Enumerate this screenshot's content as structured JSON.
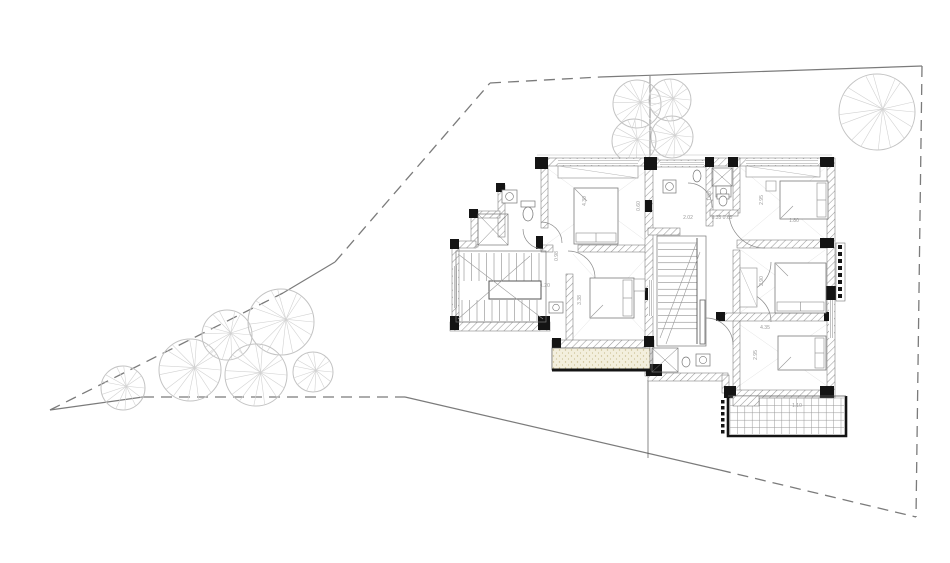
{
  "canvas": {
    "w": 950,
    "h": 563,
    "bg": "#ffffff"
  },
  "colors": {
    "boundary": "#7b7b7b",
    "tree_outline": "#c3c3c3",
    "tree_spoke": "#d2d2d2",
    "wall_black": "#141414",
    "wall_edge": "#6d6d6d",
    "hatch": "#9a9a9a",
    "thin": "#bdbdbd",
    "plan_line": "#777777",
    "door": "#8a8a8a",
    "room_x": "#e2e2e2",
    "dim_text": "#9a9a9a",
    "sand_bg": "#f3efdd",
    "sand_dot": "#c9bd8f",
    "grid": "#9a9a9a",
    "axis": "#555555"
  },
  "boundary": {
    "dashed": [
      [
        50,
        410,
        283,
        293
      ],
      [
        335,
        262,
        490,
        83
      ],
      [
        490,
        83,
        600,
        77
      ],
      [
        143,
        397,
        405,
        397
      ],
      [
        720,
        470,
        916,
        517
      ],
      [
        922,
        66,
        916,
        517
      ]
    ],
    "solid": [
      [
        283,
        293,
        335,
        262
      ],
      [
        600,
        77,
        922,
        66
      ],
      [
        50,
        410,
        143,
        397
      ],
      [
        405,
        397,
        720,
        470
      ]
    ]
  },
  "axis_lines": [
    [
      650,
      76,
      650,
      156
    ],
    [
      648,
      380,
      648,
      458
    ]
  ],
  "thin_lines": [
    [
      537,
      155,
      832,
      155
    ]
  ],
  "trees": [
    {
      "cx": 637,
      "cy": 104,
      "r": 24,
      "n": 14
    },
    {
      "cx": 670,
      "cy": 100,
      "r": 21,
      "n": 13
    },
    {
      "cx": 634,
      "cy": 141,
      "r": 22,
      "n": 13
    },
    {
      "cx": 672,
      "cy": 137,
      "r": 21,
      "n": 13
    },
    {
      "cx": 877,
      "cy": 112,
      "r": 38,
      "n": 16
    },
    {
      "cx": 123,
      "cy": 388,
      "r": 22,
      "n": 13
    },
    {
      "cx": 190,
      "cy": 370,
      "r": 31,
      "n": 15
    },
    {
      "cx": 227,
      "cy": 335,
      "r": 25,
      "n": 14
    },
    {
      "cx": 281,
      "cy": 322,
      "r": 33,
      "n": 16
    },
    {
      "cx": 256,
      "cy": 375,
      "r": 31,
      "n": 15
    },
    {
      "cx": 313,
      "cy": 372,
      "r": 20,
      "n": 13
    }
  ],
  "plan": {
    "rooms_x": [
      [
        547,
        168,
        103,
        76
      ],
      [
        573,
        254,
        77,
        84
      ],
      [
        741,
        168,
        84,
        71
      ],
      [
        741,
        250,
        84,
        62
      ],
      [
        736,
        322,
        94,
        66
      ]
    ],
    "walls_hatched": [
      [
        537,
        158,
        121,
        8
      ],
      [
        653,
        160,
        59,
        7
      ],
      [
        712,
        158,
        120,
        8
      ],
      [
        498,
        185,
        7,
        52
      ],
      [
        476,
        211,
        24,
        7
      ],
      [
        471,
        211,
        7,
        36
      ],
      [
        452,
        241,
        24,
        7
      ],
      [
        452,
        247,
        7,
        75
      ],
      [
        450,
        322,
        100,
        9
      ],
      [
        541,
        166,
        7,
        62
      ],
      [
        541,
        245,
        12,
        7
      ],
      [
        578,
        245,
        74,
        7
      ],
      [
        566,
        274,
        7,
        68
      ],
      [
        552,
        340,
        102,
        8
      ],
      [
        552,
        348,
        6,
        22
      ],
      [
        645,
        166,
        8,
        210
      ],
      [
        706,
        166,
        7,
        60
      ],
      [
        733,
        158,
        7,
        55
      ],
      [
        733,
        250,
        7,
        145
      ],
      [
        737,
        240,
        95,
        8
      ],
      [
        718,
        313,
        114,
        8
      ],
      [
        710,
        210,
        28,
        6
      ],
      [
        648,
        228,
        32,
        7
      ],
      [
        648,
        373,
        80,
        8
      ],
      [
        722,
        375,
        7,
        18
      ],
      [
        728,
        390,
        104,
        8
      ],
      [
        827,
        158,
        8,
        240
      ]
    ],
    "walls_black": [
      [
        535,
        157,
        13,
        12
      ],
      [
        644,
        157,
        13,
        13
      ],
      [
        705,
        157,
        9,
        10
      ],
      [
        728,
        157,
        10,
        10
      ],
      [
        820,
        157,
        14,
        10
      ],
      [
        496,
        183,
        9,
        9
      ],
      [
        469,
        209,
        9,
        9
      ],
      [
        450,
        239,
        9,
        10
      ],
      [
        536,
        236,
        7,
        13
      ],
      [
        450,
        316,
        9,
        14
      ],
      [
        538,
        316,
        12,
        14
      ],
      [
        552,
        338,
        9,
        10
      ],
      [
        644,
        336,
        10,
        11
      ],
      [
        645,
        200,
        7,
        12
      ],
      [
        645,
        288,
        7,
        12
      ],
      [
        646,
        364,
        16,
        12
      ],
      [
        820,
        238,
        14,
        10
      ],
      [
        824,
        286,
        16,
        14
      ],
      [
        820,
        386,
        14,
        12
      ],
      [
        724,
        386,
        12,
        12
      ],
      [
        716,
        312,
        9,
        9
      ],
      [
        824,
        312,
        9,
        9
      ]
    ],
    "windows": [
      [
        558,
        159,
        80,
        6,
        "h"
      ],
      [
        660,
        161,
        44,
        5,
        "h"
      ],
      [
        746,
        159,
        72,
        6,
        "h"
      ],
      [
        453,
        266,
        5,
        42,
        "v"
      ],
      [
        648,
        280,
        5,
        36,
        "v"
      ],
      [
        829,
        300,
        5,
        38,
        "v"
      ]
    ],
    "wardrobes": [
      [
        558,
        166,
        80,
        12
      ],
      [
        746,
        166,
        74,
        11
      ],
      [
        740,
        268,
        17,
        39
      ]
    ],
    "beds": [
      {
        "x": 574,
        "y": 188,
        "w": 44,
        "h": 56,
        "head": "s"
      },
      {
        "x": 590,
        "y": 278,
        "w": 44,
        "h": 40,
        "head": "e"
      },
      {
        "x": 780,
        "y": 181,
        "w": 48,
        "h": 38,
        "head": "e"
      },
      {
        "x": 775,
        "y": 263,
        "w": 51,
        "h": 50,
        "head": "s"
      },
      {
        "x": 778,
        "y": 336,
        "w": 48,
        "h": 34,
        "head": "e"
      }
    ],
    "nightstands": [
      [
        634,
        279,
        11,
        12
      ],
      [
        766,
        181,
        10,
        10
      ]
    ],
    "stair_left": {
      "rect": [
        456,
        251,
        90,
        71
      ],
      "band1": [
        464,
        253,
        544,
        281
      ],
      "band2": [
        462,
        300,
        544,
        321
      ],
      "step": 7.5,
      "center": [
        489,
        281,
        52,
        18
      ],
      "diagonals": [
        [
          458,
          254,
          543,
          319
        ],
        [
          458,
          319,
          530,
          256
        ]
      ]
    },
    "stair_center": {
      "rect": [
        657,
        236,
        49,
        110
      ],
      "x0": 658,
      "x1": 697,
      "y0": 243,
      "y1": 333,
      "step": 6.6,
      "rail": [
        697,
        238,
        697,
        344
      ],
      "diagonals": [
        [
          660,
          338,
          696,
          244
        ],
        [
          666,
          344,
          700,
          252
        ]
      ]
    },
    "doors": [
      {
        "cx": 543,
        "cy": 229,
        "r": 20,
        "a1": 180,
        "a2": 90,
        "sweep": 0
      },
      {
        "cx": 541,
        "cy": 243,
        "r": 21,
        "a1": 270,
        "a2": 0,
        "sweep": 1
      },
      {
        "cx": 568,
        "cy": 278,
        "r": 27,
        "a1": 270,
        "a2": 0,
        "sweep": 1
      },
      {
        "cx": 688,
        "cy": 207,
        "r": 24,
        "a1": 270,
        "a2": 0,
        "sweep": 1
      },
      {
        "cx": 765,
        "cy": 212,
        "r": 36,
        "a1": 180,
        "a2": 90,
        "sweep": 0
      },
      {
        "cx": 741,
        "cy": 262,
        "r": 30,
        "a1": 0,
        "a2": 90,
        "sweep": 1
      },
      {
        "cx": 741,
        "cy": 322,
        "r": 30,
        "a1": 270,
        "a2": 0,
        "sweep": 1
      },
      {
        "cx": 818,
        "cy": 187,
        "r": 16,
        "a1": 180,
        "a2": 90,
        "sweep": 0
      },
      {
        "cx": 706,
        "cy": 345,
        "r": 27,
        "a1": 270,
        "a2": 0,
        "sweep": 1
      }
    ],
    "showers": [
      [
        478,
        214,
        30,
        31
      ],
      [
        712,
        168,
        20,
        18
      ],
      [
        652,
        348,
        26,
        24
      ]
    ],
    "sinks": [
      [
        502,
        190,
        15,
        13
      ],
      [
        549,
        302,
        14,
        11
      ],
      [
        663,
        180,
        13,
        13
      ],
      [
        716,
        186,
        15,
        11
      ],
      [
        696,
        354,
        14,
        12
      ]
    ],
    "toilets": [
      {
        "cx": 528,
        "cy": 214,
        "rx": 5,
        "ry": 7,
        "tank": [
          521,
          201,
          14,
          6
        ]
      },
      {
        "cx": 697,
        "cy": 176,
        "rx": 4,
        "ry": 6
      },
      {
        "cx": 723,
        "cy": 201,
        "rx": 4,
        "ry": 5,
        "tank": [
          717,
          194,
          12,
          5
        ]
      },
      {
        "cx": 686,
        "cy": 362,
        "rx": 4,
        "ry": 5
      }
    ],
    "balcony": {
      "x": 552,
      "y": 348,
      "w": 98,
      "h": 22
    },
    "terrace": {
      "x": 728,
      "y": 396,
      "w": 118,
      "h": 40,
      "cell": 7.4,
      "hatch_block": [
        733,
        396,
        26,
        10
      ]
    },
    "terrace_dots": {
      "x": 721,
      "y0": 400,
      "y1": 433,
      "step": 6,
      "size": 3.5
    },
    "side_strip": {
      "x": 836,
      "y": 243,
      "w": 9,
      "h": 58,
      "squares": 8,
      "sq": 4,
      "step": 7
    },
    "rail_bar": [
      700,
      300,
      5,
      44
    ]
  },
  "dim_labels": [
    {
      "t": "1.20",
      "x": 545,
      "y": 287,
      "r": 0
    },
    {
      "t": "0.98",
      "x": 558,
      "y": 256,
      "r": -90
    },
    {
      "t": "3.38",
      "x": 581,
      "y": 300,
      "r": -90
    },
    {
      "t": "4.30",
      "x": 586,
      "y": 201,
      "r": -90
    },
    {
      "t": "0.60",
      "x": 640,
      "y": 206,
      "r": -90
    },
    {
      "t": "1.88",
      "x": 711,
      "y": 196,
      "r": -90
    },
    {
      "t": "2.02",
      "x": 688,
      "y": 219,
      "r": 0
    },
    {
      "t": "0.35 0.65",
      "x": 722,
      "y": 219,
      "r": 0
    },
    {
      "t": "2.95",
      "x": 763,
      "y": 200,
      "r": -90
    },
    {
      "t": "1.80",
      "x": 794,
      "y": 222,
      "r": 0
    },
    {
      "t": "2.90",
      "x": 763,
      "y": 281,
      "r": -90
    },
    {
      "t": "4.35",
      "x": 765,
      "y": 329,
      "r": 0
    },
    {
      "t": "2.95",
      "x": 757,
      "y": 355,
      "r": -90
    },
    {
      "t": "1.10",
      "x": 797,
      "y": 407,
      "r": 0
    }
  ]
}
